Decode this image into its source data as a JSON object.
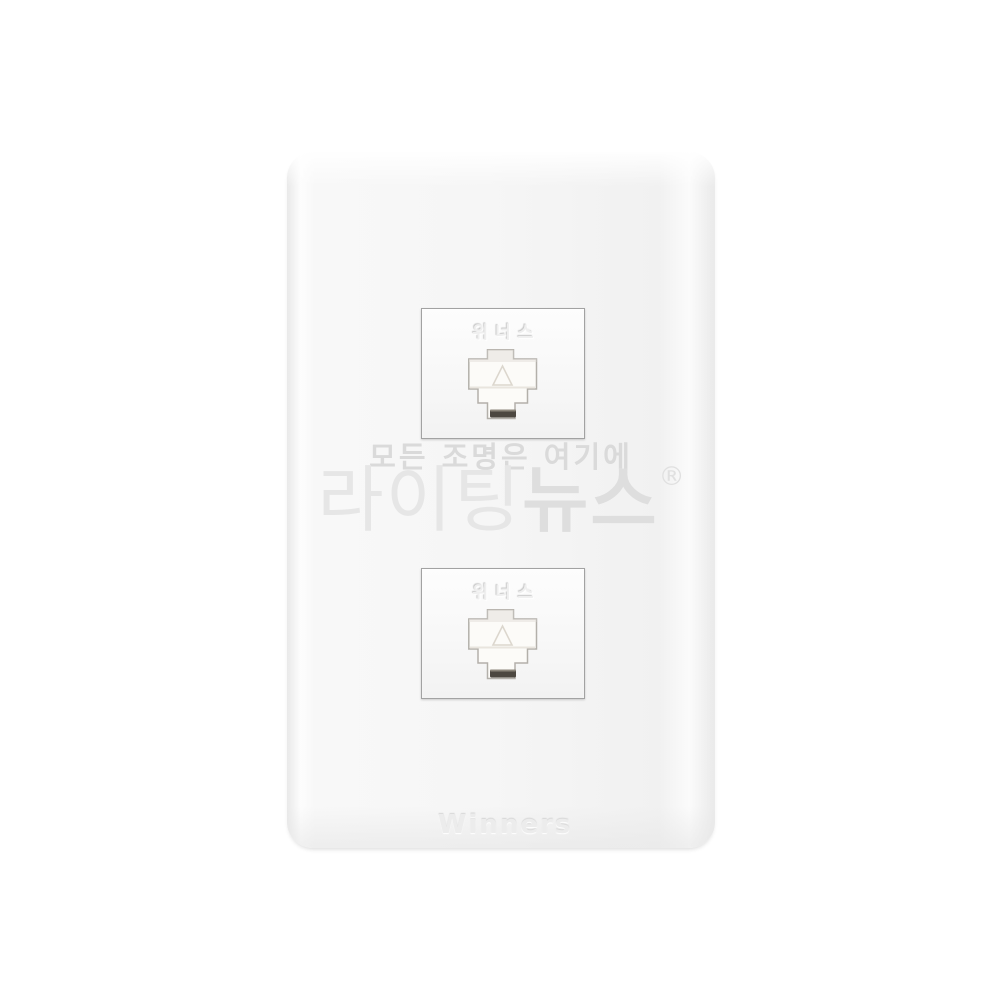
{
  "image": {
    "description": "White two-port RJ45 LAN wall outlet faceplate, product photo on white background",
    "background_color": "#ffffff",
    "plate_color": "#f5f5f5",
    "jack_frame_color": "#a2a2a2",
    "latch_slot_color": "#4c4740"
  },
  "jacks": [
    {
      "position": "top",
      "embossed_label": "위너스",
      "port_type": "rj45-socket"
    },
    {
      "position": "bottom",
      "embossed_label": "위너스",
      "port_type": "rj45-socket"
    }
  ],
  "brand": {
    "embossed_logo": "Winners"
  },
  "watermark": {
    "tagline": "모든 조명은 여기에",
    "brand_light": "라이팅",
    "brand_bold": "뉴스",
    "registered": "®",
    "color": "#e0e0e0"
  }
}
